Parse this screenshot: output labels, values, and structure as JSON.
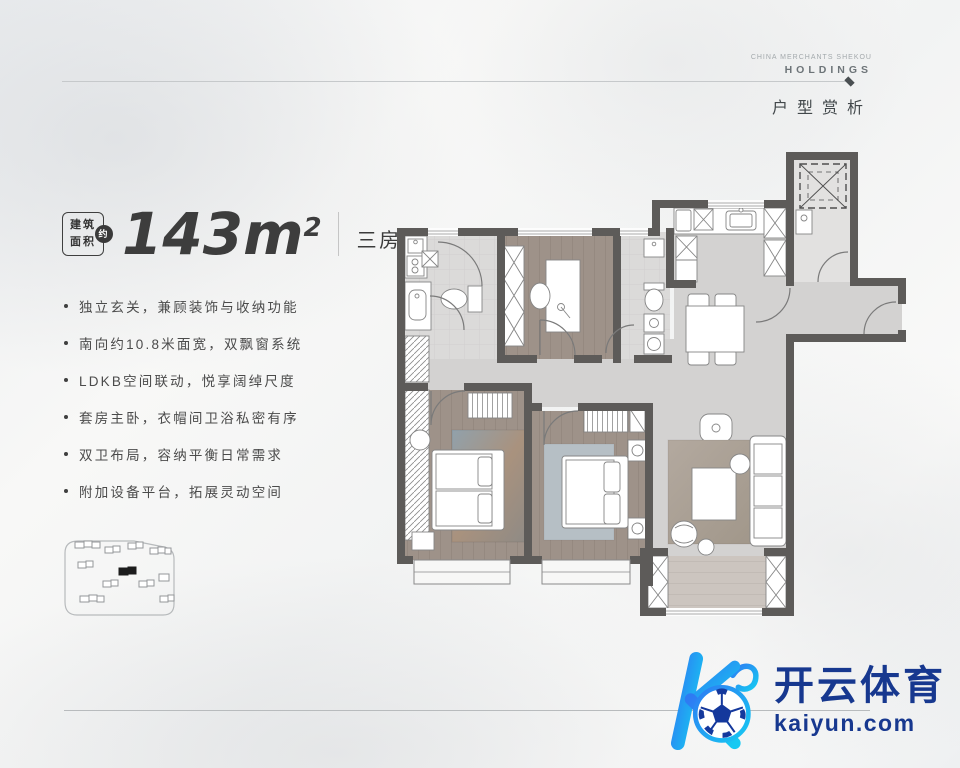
{
  "header": {
    "brand_line1": "CHINA MERCHANTS SHEKOU",
    "brand_line2": "HOLDINGS",
    "section_title": "户型赏析"
  },
  "area": {
    "badge_top": "建筑",
    "badge_bottom": "面积",
    "badge_circle": "约",
    "value": "143m",
    "exponent": "2",
    "layout": "三房两厅两卫"
  },
  "features": [
    "独立玄关，兼顾装饰与收纳功能",
    "南向约10.8米面宽，双飘窗系统",
    "LDKB空间联动，悦享阔绰尺度",
    "套房主卧，衣帽间卫浴私密有序",
    "双卫布局，容纳平衡日常需求",
    "附加设备平台，拓展灵动空间"
  ],
  "watermark": {
    "logo_text": "开云体育",
    "domain": "kaiyun.com"
  },
  "colors": {
    "accent_navy": "#17388f",
    "logo_gradient_start": "#2e7bf3",
    "logo_gradient_end": "#16c9f2",
    "wall": "#5d5b59",
    "wood_floor": "#9e9289",
    "tile_floor": "#dbdad9",
    "hall_floor": "#d3d2d1"
  }
}
